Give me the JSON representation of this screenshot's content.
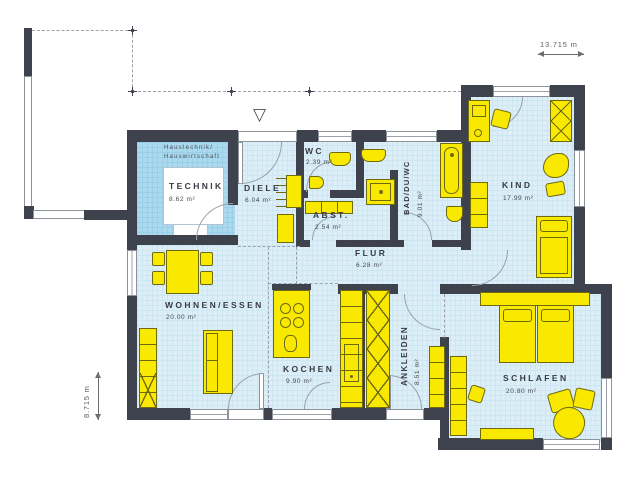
{
  "plan": {
    "type": "house-floor-plan",
    "rooms": [
      {
        "id": "technik",
        "name": "TECHNIK",
        "area": "8.62 m²",
        "sublabel_line1": "Haustechnik/",
        "sublabel_line2": "Hauswirtschaft"
      },
      {
        "id": "diele",
        "name": "DIELE",
        "area": "6.04 m²"
      },
      {
        "id": "wc",
        "name": "WC",
        "area": "2.39 m²"
      },
      {
        "id": "abstellraum",
        "name": "ABST.",
        "area": "2.54 m²"
      },
      {
        "id": "bad",
        "name": "BAD/DU/WC",
        "area": "9.01 m²"
      },
      {
        "id": "kind",
        "name": "KIND",
        "area": "17.99 m²"
      },
      {
        "id": "flur",
        "name": "FLUR",
        "area": "6.28 m²"
      },
      {
        "id": "wohnen_essen",
        "name": "WOHNEN/ESSEN",
        "area": "20.00 m²"
      },
      {
        "id": "kochen",
        "name": "KOCHEN",
        "area": "9.90 m²"
      },
      {
        "id": "ankleiden",
        "name": "ANKLEIDEN",
        "area": "8.51 m²"
      },
      {
        "id": "schlafen",
        "name": "SCHLAFEN",
        "area": "20.80 m²"
      }
    ],
    "dimensions": {
      "width": "13.715 m",
      "height": "8.715 m"
    },
    "entrance_marker": "▽",
    "colors": {
      "wall": "#3e424d",
      "floor": "#ddeef7",
      "floor_grid": "#cde6f3",
      "technik_floor": "#abdaee",
      "furniture": "#f9e800",
      "furniture_outline": "#6e6a10",
      "window": "#ffffff",
      "outline_gray": "#8d939b"
    }
  }
}
